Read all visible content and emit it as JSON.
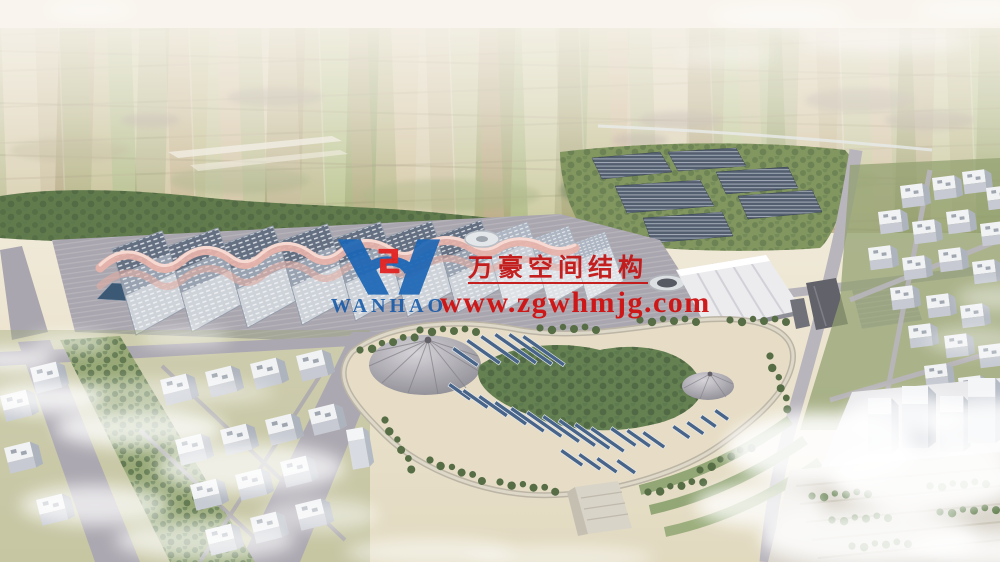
{
  "watermark": {
    "logo_text": "WANHAO",
    "company_name": "万豪空间结构",
    "website": "www.zgwhmjg.com",
    "text_color": "#c41414",
    "logo_blue": "#1b66b4",
    "logo_red": "#e01f1f"
  },
  "scene_colors": {
    "sky_haze": "#f7f3ea",
    "farmland": "#c2b183",
    "tree_green": "#5a7444",
    "exhibition_roof_panels": "#5c697c",
    "ribbon_roof_pink": "#e7b0a6",
    "park_ground_sand": "#e6dcc3",
    "park_solar_panel_blue": "#3f5c82",
    "road_grey": "#a8a4ad",
    "cloud_white": "#ffffff"
  }
}
